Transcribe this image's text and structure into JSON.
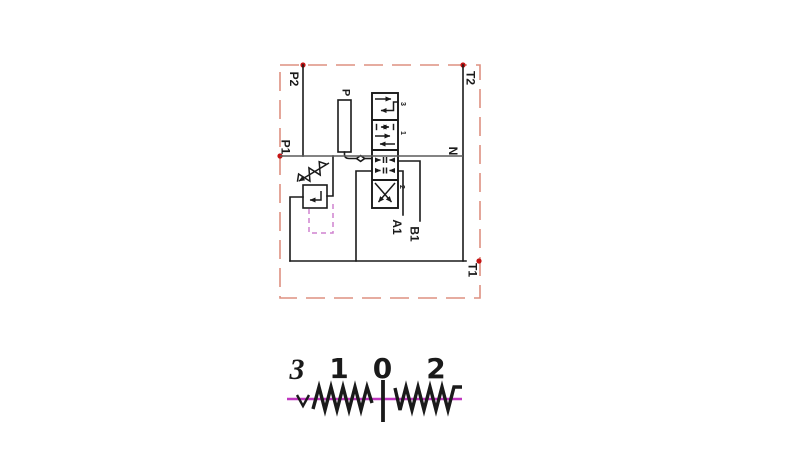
{
  "figure": {
    "type": "hydraulic-circuit-diagram",
    "port_labels": {
      "p2": "P2",
      "t2": "T2",
      "p1": "P1",
      "n": "N",
      "t1": "T1",
      "p": "P",
      "a1": "A1",
      "b1": "B1"
    },
    "valve": {
      "position_labels": [
        "3",
        "1",
        "2"
      ]
    },
    "lever_diagram": {
      "position_labels": [
        "3",
        "1",
        "0",
        "2"
      ]
    }
  },
  "colors": {
    "line": "#1a1a1a",
    "boundary": "#de9080",
    "marker_dot": "#c41414",
    "bus": "#5a5a5a",
    "magenta": "#bf36bf",
    "pilot": "#cf82cf",
    "background": "#ffffff"
  }
}
